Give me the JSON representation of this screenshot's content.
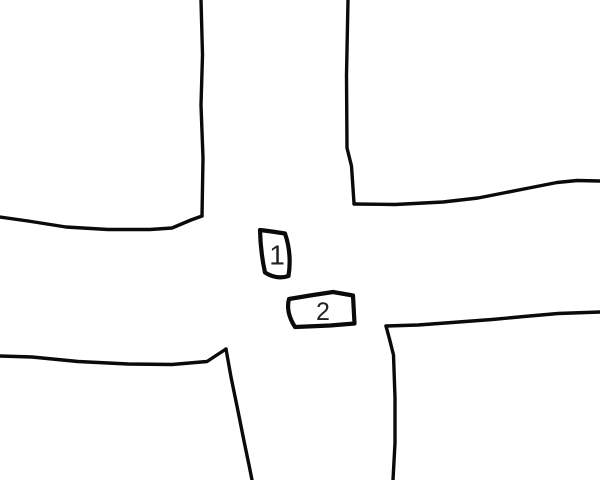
{
  "scene": {
    "background_color": "#ffffff",
    "line_color": "#0a0a0a",
    "label_color": "#222222"
  },
  "vehicles": [
    {
      "label": "1"
    },
    {
      "label": "2"
    }
  ]
}
